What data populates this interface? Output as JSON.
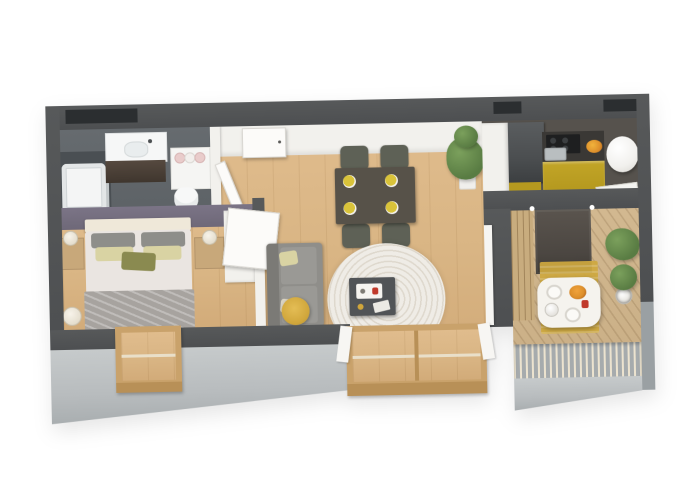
{
  "scene": {
    "kind": "3d-floor-plan-render",
    "view": "isometric-top-down",
    "rooms": [
      {
        "name": "bathroom",
        "furniture": [
          "bathtub",
          "shower-screen",
          "vanity-sink",
          "towel-shelf",
          "toilet",
          "door",
          "window"
        ]
      },
      {
        "name": "bedroom",
        "furniture": [
          "double-bed",
          "headboard",
          "pillows",
          "nightstand-left",
          "nightstand-right",
          "table-lamps",
          "wardrobe",
          "floor-lamp",
          "french-window"
        ]
      },
      {
        "name": "living-dining",
        "furniture": [
          "dining-table",
          "four-chairs",
          "four-place-settings",
          "tall-plant",
          "sofa",
          "sofa-cushions",
          "spiral-round-rug",
          "coffee-table",
          "serving-tray",
          "storage-basket",
          "glass-door",
          "curtains",
          "entrance-door"
        ]
      },
      {
        "name": "kitchen",
        "furniture": [
          "fridge",
          "tall-cabinet",
          "cooktop",
          "kitchen-sink",
          "fruit-bowl",
          "yellow-cabinets",
          "water-heater",
          "side-sink-counter"
        ]
      },
      {
        "name": "balcony",
        "furniture": [
          "outdoor-table",
          "tableware",
          "coffee-pot",
          "fruit-dish",
          "potted-plant-large",
          "potted-plant-small",
          "yellow-outdoor-rug",
          "wood-deck",
          "slat-railing",
          "sliding-door"
        ]
      }
    ]
  },
  "colors": {
    "bg": "#ffffff",
    "wall_dark": "#57595a",
    "wall_recess": "#2b2e30",
    "wall_front": "#b8bcbe",
    "floor_wood": "#d9b584",
    "floor_bath": "#5d6266",
    "tile_dark": "#4a4f53",
    "accent_wall": "#6e6878",
    "partition_white": "#f2f1ed",
    "kitchen_yellow": "#b5991f",
    "counter_dark": "#3a3835",
    "fridge": "#4b4e50",
    "cooktop": "#1e1f20",
    "kitchen_floor": "#56524d",
    "deck": "#c9ae85",
    "slat_wood": "#c8ac7e",
    "railing_base": "#a6abad",
    "railing_slat": "#ece3cf",
    "rug_cream": "#efece6",
    "rug_ring": "#ded8cd",
    "sofa": "#8f8e8a",
    "sofa_back": "#7b7a76",
    "basket": "#d0a63b",
    "bed_duvet": "#eae5e1",
    "bed_blanket": "#a7a39f",
    "pillow_gray": "#8e8e8a",
    "pillow_yellow": "#d9d3a3",
    "pillow_olive": "#8a8a50",
    "headboard": "#efe8d9",
    "nightstand": "#c8a87a",
    "wood_frame": "#c9a26b",
    "table_dining": "#575249",
    "chair": "#5e6156",
    "plate": "#d9c33a",
    "plant": "#597c43",
    "plant_light": "#7ba05c",
    "balcony_table": "#f5f3ee",
    "door_dark": "#4b4641",
    "heater_white": "#f1f0ed",
    "bowl_orange": "#dd8f2b",
    "accent_red": "#c0392b"
  }
}
